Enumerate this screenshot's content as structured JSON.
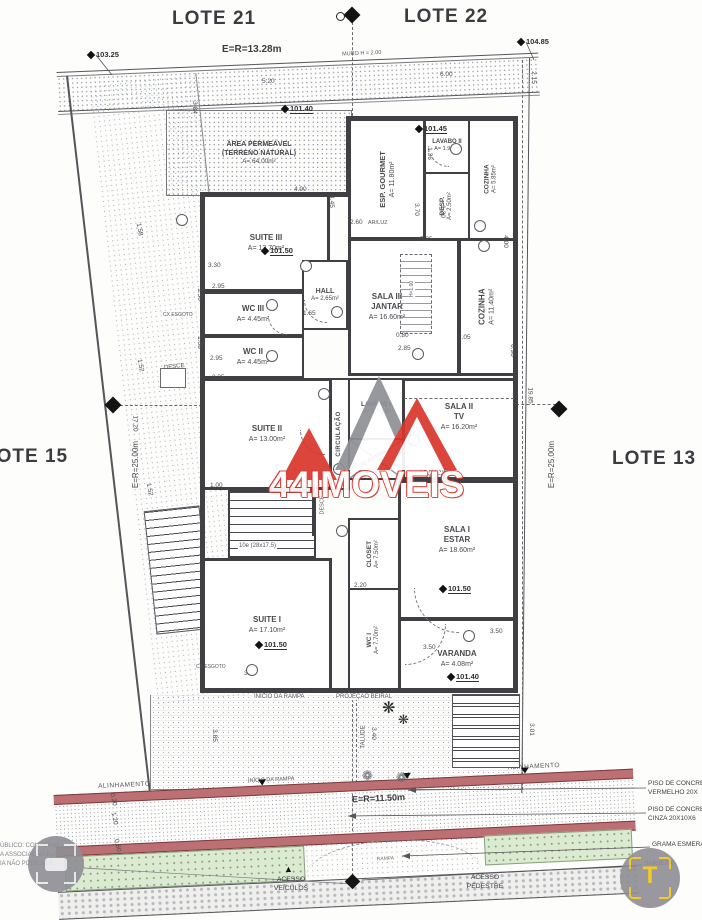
{
  "lots": {
    "lote21": "LOTE 21",
    "lote22": "LOTE 22",
    "lote15": "LOTE 15",
    "lote13": "LOTE 13"
  },
  "boundaries": {
    "top": "E=R=13.28m",
    "left": "E=R=25.00m",
    "right": "E=R=25.00m",
    "street": "E=R=11.50m",
    "muro": "MURO H = 2.00",
    "alinhamento_left": "ALINHAMENTO",
    "alinhamento_right": "ALINHAMENTO"
  },
  "rooms": {
    "area_permeavel": {
      "l1": "ÁREA PERMEÁVEL",
      "l2": "(TERRENO NATURAL)",
      "l3": "A= 64.00m²"
    },
    "esp_gourmet": {
      "name": "ESP. GOURMET",
      "area": "A= 11.80m²"
    },
    "lavabo2": {
      "name": "LAVABO II",
      "area": "A= 1.95m²"
    },
    "desp": {
      "name": "DESP.",
      "area": "A= 2.50m²"
    },
    "cozinha_peq": {
      "name": "COZINHA",
      "area": "A= 5.85m²"
    },
    "suite3": {
      "name": "SUITE III",
      "area": "A= 13.70m²"
    },
    "wc3": {
      "name": "WC III",
      "area": "A= 4.45m²"
    },
    "wc2": {
      "name": "WC II",
      "area": "A= 4.45m²"
    },
    "hall": {
      "name": "HALL",
      "area": "A= 2.65m²"
    },
    "sala3": {
      "name": "SALA III",
      "name2": "JANTAR",
      "area": "A= 16.60m²"
    },
    "cozinha": {
      "name": "COZINHA",
      "area": "A= 11.40m²"
    },
    "suite2": {
      "name": "SUITE II",
      "area": "A= 13.00m²"
    },
    "circulacao": {
      "name": "CIRCULAÇÃO"
    },
    "lavabo1": {
      "name": "LAVABO I",
      "area": "A= 2.85m²"
    },
    "jd_interno": {
      "name": "JD INTERNO"
    },
    "sala2": {
      "name": "SALA II",
      "name2": "TV",
      "area": "A= 16.20m²"
    },
    "closet": {
      "name": "CLOSET",
      "area": "A= 7.50m²"
    },
    "wc1": {
      "name": "WC I",
      "area": "A= 7.70m²"
    },
    "sala1": {
      "name": "SALA I",
      "name2": "ESTAR",
      "area": "A= 18.60m²"
    },
    "suite1": {
      "name": "SUITE I",
      "area": "A= 17.10m²"
    },
    "varanda": {
      "name": "VARANDA",
      "area": "A= 4.08m²"
    }
  },
  "elevations": [
    {
      "v": "103.25",
      "x": 88,
      "y": 50,
      "nu": true
    },
    {
      "v": "104.85",
      "x": 518,
      "y": 37,
      "nu": true
    },
    {
      "v": "101.40",
      "x": 282,
      "y": 104
    },
    {
      "v": "101.45",
      "x": 416,
      "y": 124
    },
    {
      "v": "101.50",
      "x": 262,
      "y": 246
    },
    {
      "v": "101.50",
      "x": 440,
      "y": 584
    },
    {
      "v": "101.50",
      "x": 256,
      "y": 640
    },
    {
      "v": "101.40",
      "x": 448,
      "y": 672
    }
  ],
  "dims": [
    {
      "t": "5.20",
      "x": 262,
      "y": 78
    },
    {
      "t": "6.00",
      "x": 440,
      "y": 71
    },
    {
      "t": "2.15",
      "x": 527,
      "y": 74,
      "r": 90
    },
    {
      "t": "3.84",
      "x": 188,
      "y": 104,
      "r": 90
    },
    {
      "t": "4.90",
      "x": 294,
      "y": 186
    },
    {
      "t": "4.45",
      "x": 325,
      "y": 198,
      "r": 90
    },
    {
      "t": "3.30",
      "x": 208,
      "y": 262
    },
    {
      "t": "2.95",
      "x": 212,
      "y": 283
    },
    {
      "t": "1.50",
      "x": 193,
      "y": 291,
      "r": 90
    },
    {
      "t": "2.95",
      "x": 210,
      "y": 355
    },
    {
      "t": "1.50",
      "x": 193,
      "y": 339,
      "r": 90
    },
    {
      "t": "3.25",
      "x": 212,
      "y": 374
    },
    {
      "t": "1.58",
      "x": 133,
      "y": 226,
      "r": 80
    },
    {
      "t": "1.52",
      "x": 134,
      "y": 362,
      "r": 80
    },
    {
      "t": "1.52",
      "x": 143,
      "y": 486,
      "r": 80
    },
    {
      "t": "17.20",
      "x": 127,
      "y": 420,
      "r": 90
    },
    {
      "t": "19.85",
      "x": 522,
      "y": 392,
      "r": 90
    },
    {
      "t": "1.65",
      "x": 303,
      "y": 310
    },
    {
      "t": "2.60",
      "x": 350,
      "y": 219
    },
    {
      "t": "3.70",
      "x": 410,
      "y": 206,
      "r": 90
    },
    {
      "t": "1.36",
      "x": 423,
      "y": 150,
      "r": 90
    },
    {
      "t": "1.30",
      "x": 436,
      "y": 208,
      "r": 90
    },
    {
      "t": "5.85",
      "x": 420,
      "y": 236
    },
    {
      "t": "4.00",
      "x": 499,
      "y": 238,
      "r": 90
    },
    {
      "t": "0.80",
      "x": 396,
      "y": 332
    },
    {
      "t": "2.85",
      "x": 398,
      "y": 345
    },
    {
      "t": "2.05",
      "x": 458,
      "y": 334
    },
    {
      "t": "0.90",
      "x": 506,
      "y": 347,
      "r": 90
    },
    {
      "t": "2.20",
      "x": 354,
      "y": 582
    },
    {
      "t": "3.50",
      "x": 490,
      "y": 628
    },
    {
      "t": "3.50",
      "x": 423,
      "y": 644
    },
    {
      "t": "3.70",
      "x": 244,
      "y": 670
    },
    {
      "t": "1.00",
      "x": 210,
      "y": 482
    },
    {
      "t": "3.01",
      "x": 525,
      "y": 726,
      "r": 90
    },
    {
      "t": "3.85",
      "x": 208,
      "y": 732,
      "r": 90
    },
    {
      "t": "3.40",
      "x": 367,
      "y": 730,
      "r": 90
    },
    {
      "t": "0.20",
      "x": 107,
      "y": 796,
      "r": 78
    },
    {
      "t": "1.20",
      "x": 108,
      "y": 815,
      "r": 78
    },
    {
      "t": "0.80",
      "x": 111,
      "y": 842,
      "r": 78
    }
  ],
  "tags": [
    {
      "x": 176,
      "y": 214
    },
    {
      "x": 266,
      "y": 299
    },
    {
      "x": 266,
      "y": 350
    },
    {
      "x": 331,
      "y": 306
    },
    {
      "x": 300,
      "y": 260
    },
    {
      "x": 450,
      "y": 143
    },
    {
      "x": 474,
      "y": 220
    },
    {
      "x": 478,
      "y": 240
    },
    {
      "x": 318,
      "y": 388
    },
    {
      "x": 333,
      "y": 463
    },
    {
      "x": 408,
      "y": 434
    },
    {
      "x": 336,
      "y": 525
    },
    {
      "x": 463,
      "y": 630
    },
    {
      "x": 246,
      "y": 664
    },
    {
      "x": 412,
      "y": 348
    }
  ],
  "notes": {
    "cp_pluvial_1": "CP PLUVIAL",
    "cp_pluvial_2": "DESCE",
    "ar_luz": "AR/LUZ",
    "stair_note": "10e (28x17.5)",
    "desce_left": "DESCE",
    "desce_mid": "DESCE",
    "cx_esgoto_1": "CX ESGOTO",
    "cx_esgoto_2": "CX ESGOTO",
    "h_counter": "H=1.00",
    "inicio_rampa_1": "INÍCIO DA RAMPA",
    "inicio_rampa_2": "INÍCIO DA RAMPA",
    "projecao": "PROJEÇÃO BEIRAL",
    "talude": "TALUDE",
    "rampa": "RAMPA"
  },
  "street_labels": {
    "acesso_veiculos_1": "ACESSO",
    "acesso_veiculos_2": "VEÍCULOS",
    "acesso_pedestre_1": "ACESSO",
    "acesso_pedestre_2": "PEDESTRE"
  },
  "legend": {
    "item1_l1": "PISO DE CONCRE",
    "item1_l2": "VERMELHO 20X",
    "item2_l1": "PISO DE CONCRE",
    "item2_l2": "CINZA 20X10X6",
    "item3": "GRAMA ESMERA",
    "item4": "SARJETA"
  },
  "watermark": {
    "brand_prefix": "44",
    "brand": "IMOVEIS",
    "corner_l1": "ÚBLICO: CONFORME",
    "corner_l2": "A ASSOCIAÇÃO  ELA",
    "corner_l3": "IA NÃO PODE SER",
    "logo_letter": "T"
  },
  "colors": {
    "accent_red": "#d8362c",
    "band_red": "#bd7074",
    "grass_green": "#dcead2",
    "logo_yellow": "#f3c50f",
    "ink": "#404044"
  }
}
